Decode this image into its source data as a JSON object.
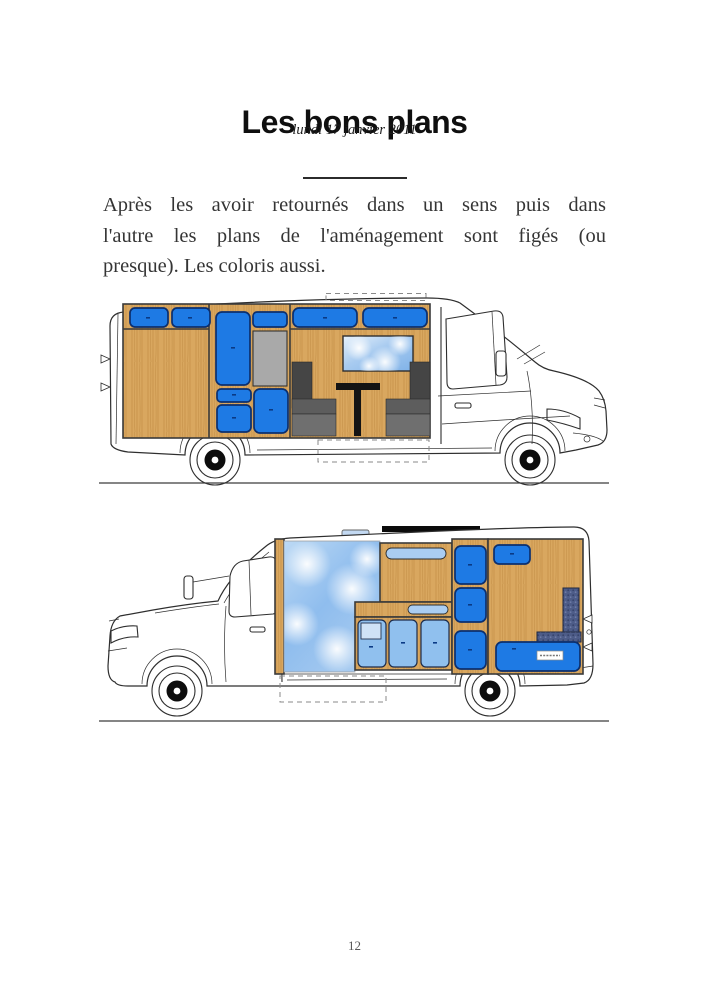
{
  "article": {
    "title": "Les bons plans",
    "date": "lundi 17 janvier 2011",
    "lines": [
      "Après les avoir retournés dans un sens puis dans",
      "l'autre les plans de l'aménagement sont figés (ou",
      "presque). Les coloris aussi."
    ],
    "page_number": "12"
  },
  "figures": {
    "top": "camper-van-plan-right-profile",
    "bottom": "camper-van-plan-left-profile"
  },
  "colors": {
    "accent_blue": "#1e7ae4",
    "accent_blue_dark": "#0c2f6e",
    "light_blue": "#90c0ee",
    "pale_blue": "#aacdf2",
    "vent_blue": "#c3d9f2",
    "wood": "#d9a75f",
    "wood_dark": "#b9873f",
    "gray_panel": "#a9a9a9",
    "sky_light": "#e8f2fb",
    "sky_dark": "#7fb2e8",
    "seat_dark": "#454545",
    "seat_mid": "#5d5d5d",
    "seat_light": "#6f6f6f",
    "navy_cushion": "#4d5c88",
    "table_black": "#141414",
    "line": "#2e2e2e",
    "text": "#353535"
  }
}
